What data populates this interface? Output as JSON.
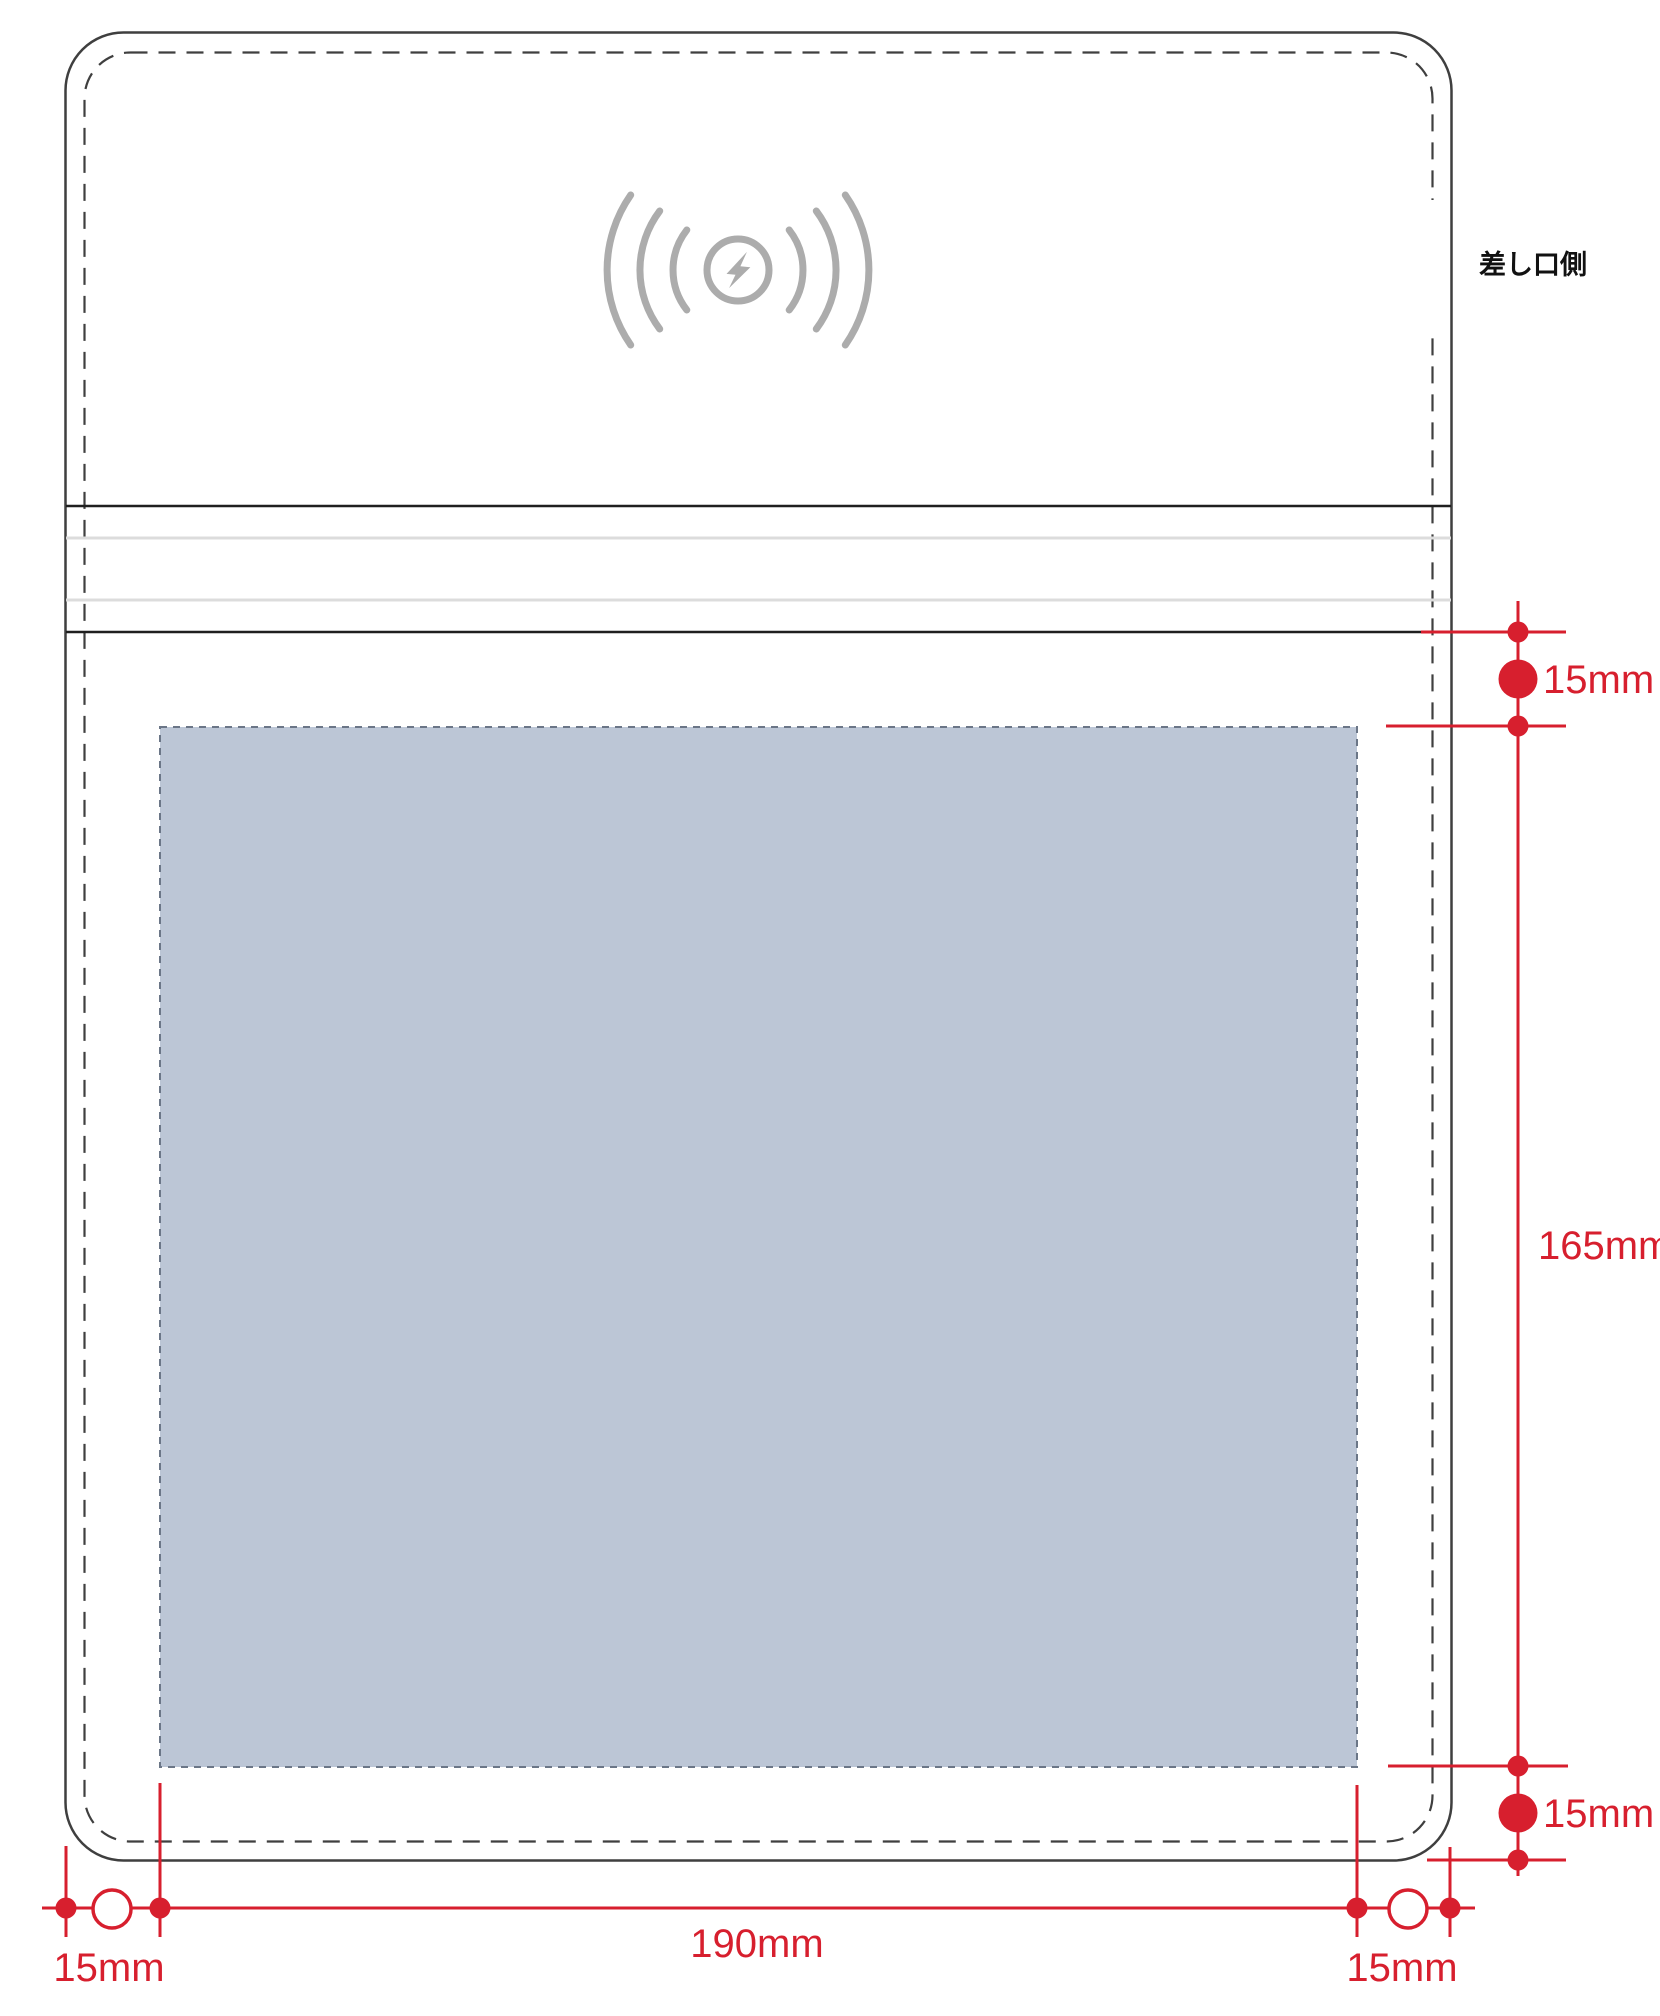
{
  "side_label": "差し口側",
  "dimensions": {
    "top_gap": "15mm",
    "print_height": "165mm",
    "bottom_gap": "15mm",
    "left_margin": "15mm",
    "print_width": "190mm",
    "right_margin": "15mm"
  },
  "icons": {
    "wireless_charging": "wireless-charging-icon"
  },
  "colors": {
    "red": "#d71f2e",
    "blue_fill": "#bcc6d6",
    "blue_border": "#6b7687",
    "outline": "#3f3f3f",
    "icon_gray": "#acacac",
    "band_light": "#dcdcdc",
    "band_dark": "#1f1f1f",
    "text_dark": "#111111"
  }
}
